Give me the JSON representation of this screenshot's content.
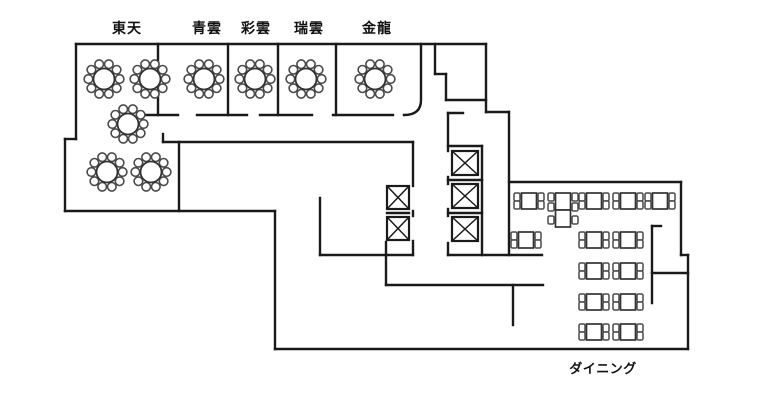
{
  "labels": {
    "rooms": [
      {
        "id": "toten",
        "text": "東天",
        "x": 127,
        "y": 33,
        "size": 14
      },
      {
        "id": "seiun",
        "text": "青雲",
        "x": 207,
        "y": 33,
        "size": 14
      },
      {
        "id": "saiun",
        "text": "彩雲",
        "x": 256,
        "y": 33,
        "size": 14
      },
      {
        "id": "zuiun",
        "text": "瑞雲",
        "x": 309,
        "y": 33,
        "size": 14
      },
      {
        "id": "kinryu",
        "text": "金龍",
        "x": 377,
        "y": 33,
        "size": 14
      }
    ],
    "dining": {
      "id": "dining",
      "text": "ダイニング",
      "x": 603,
      "y": 373,
      "size": 13
    }
  },
  "colors": {
    "wall": "#1a1a1a",
    "table_stroke": "#333333",
    "chair_stroke": "#4a4a4a",
    "fill": "#ffffff"
  },
  "plan": {
    "walls": [
      [
        76,
        44,
        486,
        44
      ],
      [
        76,
        44,
        76,
        139
      ],
      [
        65,
        139,
        76,
        139
      ],
      [
        65,
        139,
        65,
        211
      ],
      [
        65,
        211,
        275,
        211
      ],
      [
        275,
        211,
        275,
        349
      ],
      [
        275,
        349,
        688,
        349
      ],
      [
        688,
        255,
        688,
        349
      ],
      [
        681,
        255,
        688,
        255
      ],
      [
        681,
        182,
        681,
        255
      ],
      [
        509,
        182,
        681,
        182
      ],
      [
        158,
        44,
        158,
        115
      ],
      [
        228,
        44,
        228,
        115
      ],
      [
        278,
        44,
        278,
        115
      ],
      [
        336,
        44,
        336,
        115
      ],
      [
        143,
        115,
        178,
        115
      ],
      [
        197,
        115,
        247,
        115
      ],
      [
        260,
        115,
        312,
        115
      ],
      [
        333,
        115,
        393,
        115
      ],
      [
        435,
        44,
        435,
        74
      ],
      [
        435,
        74,
        446,
        74
      ],
      [
        446,
        74,
        446,
        100
      ],
      [
        446,
        100,
        486,
        100
      ],
      [
        486,
        44,
        486,
        112
      ],
      [
        486,
        112,
        509,
        112
      ],
      [
        509,
        112,
        509,
        255
      ],
      [
        448,
        113,
        463,
        113
      ],
      [
        448,
        113,
        448,
        151
      ],
      [
        448,
        146,
        482,
        146
      ],
      [
        482,
        146,
        482,
        255
      ],
      [
        448,
        180,
        482,
        180
      ],
      [
        448,
        213,
        482,
        213
      ],
      [
        448,
        177,
        448,
        184
      ],
      [
        448,
        209,
        448,
        216
      ],
      [
        448,
        243,
        448,
        255
      ],
      [
        448,
        255,
        542,
        255
      ],
      [
        320,
        255,
        413,
        255
      ],
      [
        386,
        255,
        386,
        285
      ],
      [
        386,
        285,
        543,
        285
      ],
      [
        513,
        285,
        513,
        325
      ],
      [
        320,
        198,
        320,
        255
      ],
      [
        413,
        142,
        413,
        186
      ],
      [
        413,
        211,
        413,
        216
      ],
      [
        413,
        241,
        413,
        255
      ],
      [
        386,
        242,
        386,
        255
      ],
      [
        387,
        213,
        409,
        213
      ],
      [
        163,
        134,
        163,
        142
      ],
      [
        163,
        142,
        413,
        142
      ],
      [
        179,
        142,
        179,
        211
      ],
      [
        652,
        226,
        652,
        303
      ],
      [
        652,
        273,
        688,
        273
      ],
      [
        652,
        226,
        661,
        226
      ]
    ],
    "wall_paths": [
      "M 421 44 L 421 100 Q 421 115 404 115"
    ],
    "round_tables": [
      [
        104,
        79
      ],
      [
        150,
        79
      ],
      [
        204,
        79
      ],
      [
        255,
        79
      ],
      [
        306,
        79
      ],
      [
        375,
        79
      ],
      [
        128,
        124
      ],
      [
        107,
        172
      ],
      [
        151,
        172
      ]
    ],
    "square_tables": [
      [
        529,
        201
      ],
      [
        594,
        201
      ],
      [
        628,
        201
      ],
      [
        660,
        201
      ],
      [
        526,
        240
      ],
      [
        594,
        240
      ],
      [
        628,
        240
      ],
      [
        594,
        271
      ],
      [
        628,
        271
      ],
      [
        594,
        302
      ],
      [
        628,
        302
      ],
      [
        594,
        332
      ],
      [
        628,
        332
      ]
    ],
    "pair_tables": [
      {
        "x": 563,
        "y_top": 193,
        "w": 15,
        "h": 17
      }
    ],
    "elevators": [
      [
        387,
        186,
        22,
        23
      ],
      [
        387,
        217,
        22,
        23
      ],
      [
        452,
        151,
        26,
        24
      ],
      [
        452,
        184,
        26,
        24
      ],
      [
        452,
        217,
        26,
        24
      ]
    ],
    "round_table_style": {
      "table_r": 10.5,
      "chair_r": 4.3,
      "ring_r": 15.6,
      "n_chairs": 10,
      "start_deg": -72
    },
    "square_table_style": {
      "w": 15,
      "h": 16,
      "chair_w": 6,
      "chair_h": 8
    }
  }
}
